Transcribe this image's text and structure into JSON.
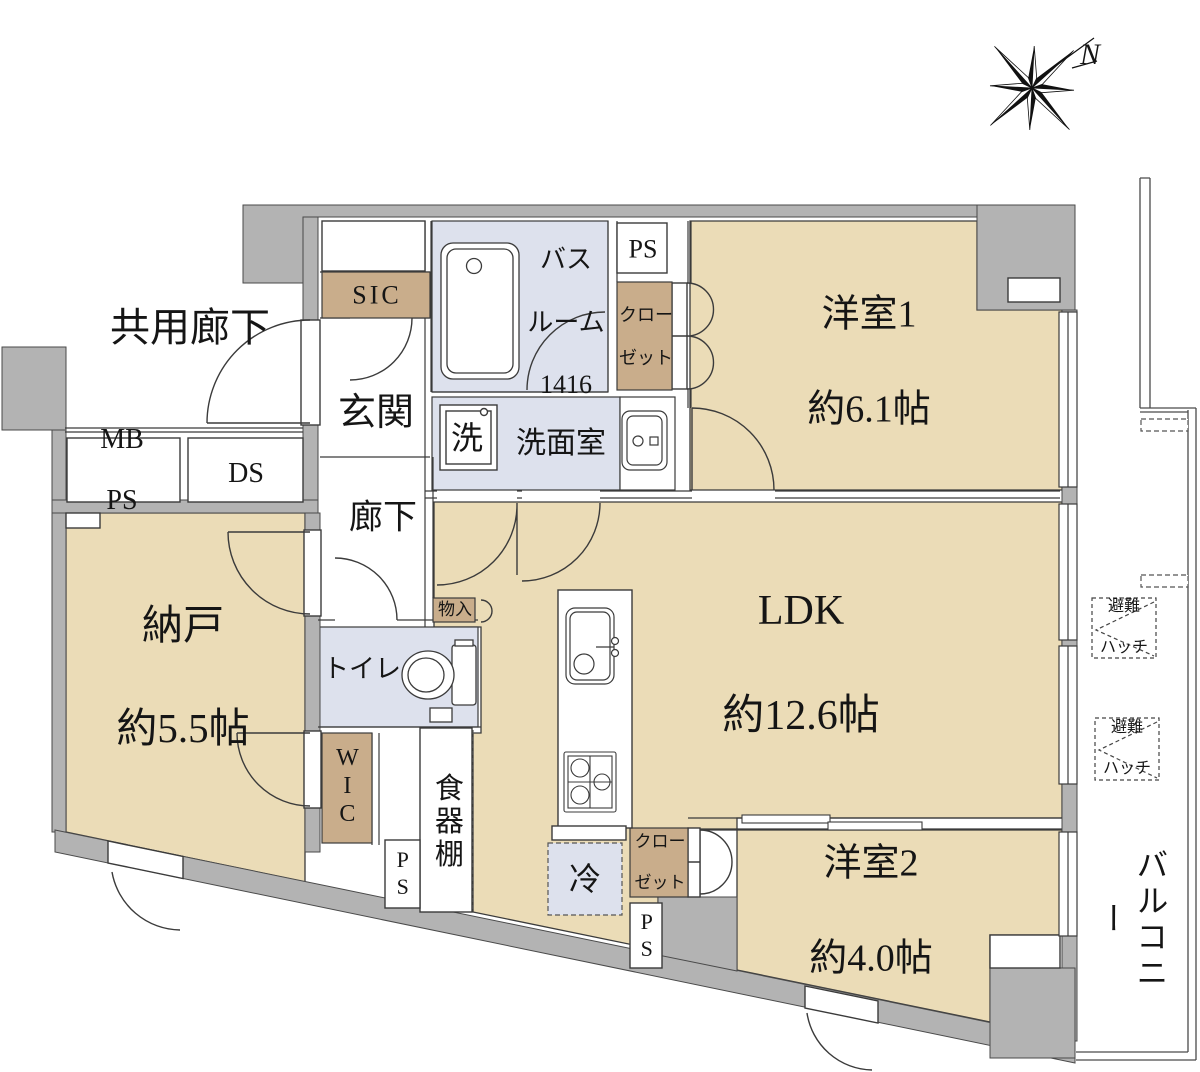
{
  "colors": {
    "floor_tan": "#ebdcb7",
    "furniture_tan": "#c9ad8b",
    "wet_blue": "#dde1ed",
    "wall_gray": "#b3b3b3",
    "line": "#3b3b3b"
  },
  "compass": {
    "north_label": "N"
  },
  "outside": {
    "common_corridor": "共用廊下",
    "balcony": "バルコニー",
    "hatch1_line1": "避難",
    "hatch1_line2": "ハッチ",
    "hatch2_line1": "避難",
    "hatch2_line2": "ハッチ"
  },
  "rooms": {
    "bedroom1": {
      "name": "洋室1",
      "size": "約6.1帖"
    },
    "bedroom2": {
      "name": "洋室2",
      "size": "約4.0帖"
    },
    "ldk": {
      "name": "LDK",
      "size": "約12.6帖"
    },
    "storage_room": {
      "name": "納戸",
      "size": "約5.5帖"
    },
    "entrance": "玄関",
    "hallway": "廊下",
    "washroom": "洗面室",
    "bathroom_line1": "バス",
    "bathroom_line2": "ルーム",
    "bathroom_line3": "1416",
    "toilet": "トイレ",
    "wic": "WIC",
    "sic": "SIC"
  },
  "fixtures": {
    "washer": "洗",
    "fridge": "冷",
    "cupboard": "食器棚",
    "storage_small": "物入",
    "closet_top_line1": "クロー",
    "closet_top_line2": "ゼット",
    "closet_bottom_line1": "クロー",
    "closet_bottom_line2": "ゼット"
  },
  "shafts": {
    "ps_top": "PS",
    "mb_ps_line1": "MB",
    "mb_ps_line2": "PS",
    "ds": "DS",
    "ps_left": "PS",
    "ps_bottom": "PS"
  }
}
